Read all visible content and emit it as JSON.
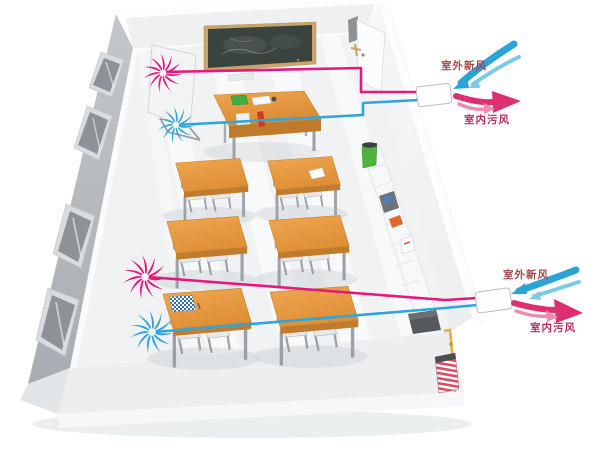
{
  "illustration": {
    "vent_units": [
      {
        "position": "top-right",
        "fresh_air_label": "室外新风",
        "exhaust_air_label": "室内污风"
      },
      {
        "position": "bottom-right",
        "fresh_air_label": "室外新风",
        "exhaust_air_label": "室内污风"
      }
    ],
    "scene_counts": {
      "student_desks": 6,
      "chairs_per_desk": 2,
      "teacher_desks": 1,
      "blackboards": 1,
      "windows": 4,
      "fan_swirls": 4,
      "vent_units": 2
    }
  },
  "colors": {
    "fresh_air_blue": "#2ba3d6",
    "fresh_air_blue_light": "#7ec8e8",
    "exhaust_pink": "#dd2f72",
    "exhaust_pink_light": "#ec8cae",
    "pipe_pink": "#e6187e",
    "pipe_blue": "#31a5da",
    "fresh_label_text": "#a04a4c",
    "exhaust_label_text": "#b73060",
    "desk_wood": "#e8993f",
    "blackboard_surface": "#3a433e",
    "blackboard_frame": "#c9a56b",
    "left_wall_gray": "#b5b9be",
    "floor_white": "#f0f2f3",
    "trash_can_green": "#4db33c",
    "gas_pipe_yellow": "#ddb13c",
    "radiator_red": "#d54e6a"
  },
  "icons": [
    {
      "name": "exhaust-fan-swirl-icon",
      "color": "#e6187e",
      "count": 2
    },
    {
      "name": "supply-fan-swirl-icon",
      "color": "#31a5da",
      "count": 2
    },
    {
      "name": "fresh-air-arrows-icon",
      "color": "#2ba3d6",
      "count": 2
    },
    {
      "name": "exhaust-air-arrows-icon",
      "color": "#dd2f72",
      "count": 2
    }
  ]
}
